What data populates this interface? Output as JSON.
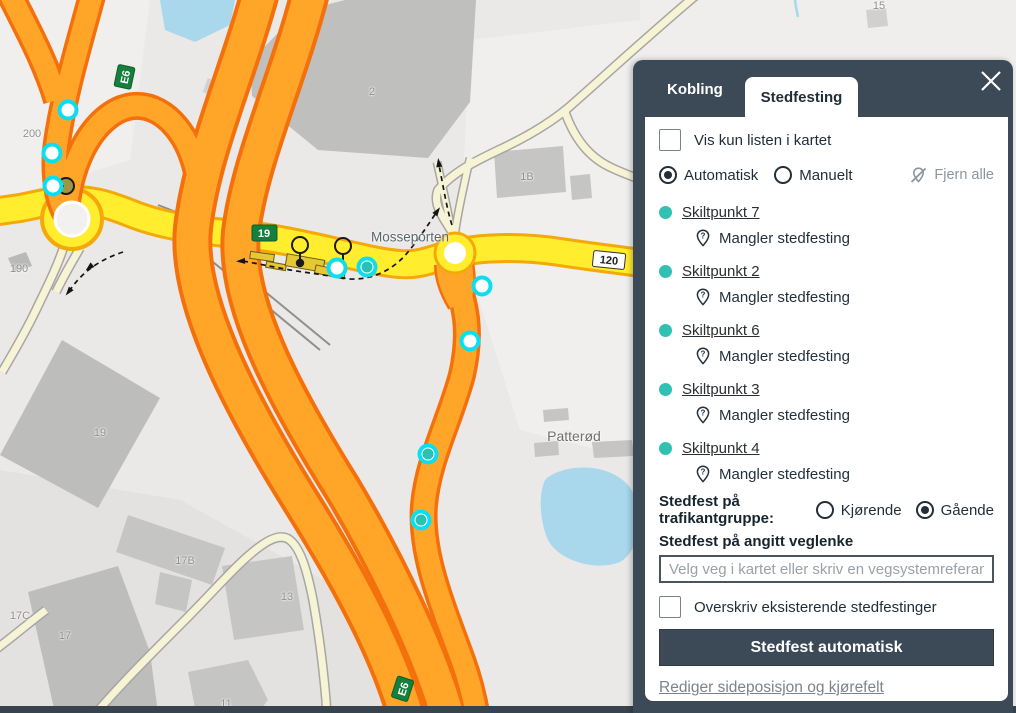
{
  "map": {
    "place_labels": {
      "mosseporten": "Mosseporten",
      "patterod": "Patterød"
    },
    "badges": {
      "e6": "E6",
      "r19": "19",
      "r120": "120"
    },
    "house_numbers": [
      {
        "t": "200",
        "x": 32,
        "y": 134
      },
      {
        "t": "190",
        "x": 19,
        "y": 269
      },
      {
        "t": "2",
        "x": 372,
        "y": 92
      },
      {
        "t": "1B",
        "x": 527,
        "y": 177
      },
      {
        "t": "19",
        "x": 100,
        "y": 433
      },
      {
        "t": "17B",
        "x": 185,
        "y": 561
      },
      {
        "t": "13",
        "x": 287,
        "y": 597
      },
      {
        "t": "17",
        "x": 65,
        "y": 636
      },
      {
        "t": "17C",
        "x": 20,
        "y": 616
      },
      {
        "t": "11",
        "x": 226,
        "y": 704
      },
      {
        "t": "15",
        "x": 879,
        "y": 6
      }
    ],
    "markers": [
      {
        "x": 68,
        "y": 110,
        "v": "white"
      },
      {
        "x": 52,
        "y": 153,
        "v": "white"
      },
      {
        "x": 53,
        "y": 186,
        "v": "white"
      },
      {
        "x": 337,
        "y": 268,
        "v": "white"
      },
      {
        "x": 367,
        "y": 267,
        "v": "teal"
      },
      {
        "x": 482,
        "y": 286,
        "v": "white"
      },
      {
        "x": 470,
        "y": 341,
        "v": "white"
      },
      {
        "x": 428,
        "y": 454,
        "v": "teal"
      },
      {
        "x": 421,
        "y": 520,
        "v": "teal"
      }
    ],
    "colors": {
      "marker_ring": "#0BDFEF",
      "marker_teal": "#29C2B4",
      "motorway": "#FFA629",
      "motorway_casing": "#F4700C",
      "road_yellow": "#FFED2E",
      "road_yellow_casing": "#F5A80A",
      "road_pale": "#F7F4D6",
      "water": "#A9D7EC",
      "building": "#C5C5C4"
    }
  },
  "panel": {
    "tabs": [
      {
        "label": "Kobling",
        "active": false
      },
      {
        "label": "Stedfesting",
        "active": true
      }
    ],
    "show_only_list_label": "Vis kun listen i kartet",
    "mode": {
      "options": [
        "Automatisk",
        "Manuelt"
      ],
      "selected": "Automatisk"
    },
    "remove_all_label": "Fjern alle",
    "sign_points": [
      {
        "name": "Skiltpunkt 7",
        "status": "Mangler stedfesting"
      },
      {
        "name": "Skiltpunkt 2",
        "status": "Mangler stedfesting"
      },
      {
        "name": "Skiltpunkt 6",
        "status": "Mangler stedfesting"
      },
      {
        "name": "Skiltpunkt 3",
        "status": "Mangler stedfesting"
      },
      {
        "name": "Skiltpunkt 4",
        "status": "Mangler stedfesting"
      }
    ],
    "traffic_group": {
      "label": "Stedfest på trafikantgruppe:",
      "options": [
        "Kjørende",
        "Gående"
      ],
      "selected": "Gående"
    },
    "road_link": {
      "label": "Stedfest på angitt veglenke",
      "placeholder": "Velg veg i kartet eller skriv en vegsystemreferanse"
    },
    "overwrite_label": "Overskriv eksisterende stedfestinger",
    "submit_label": "Stedfest automatisk",
    "edit_link": "Rediger sideposisjon og kjørefelt"
  }
}
